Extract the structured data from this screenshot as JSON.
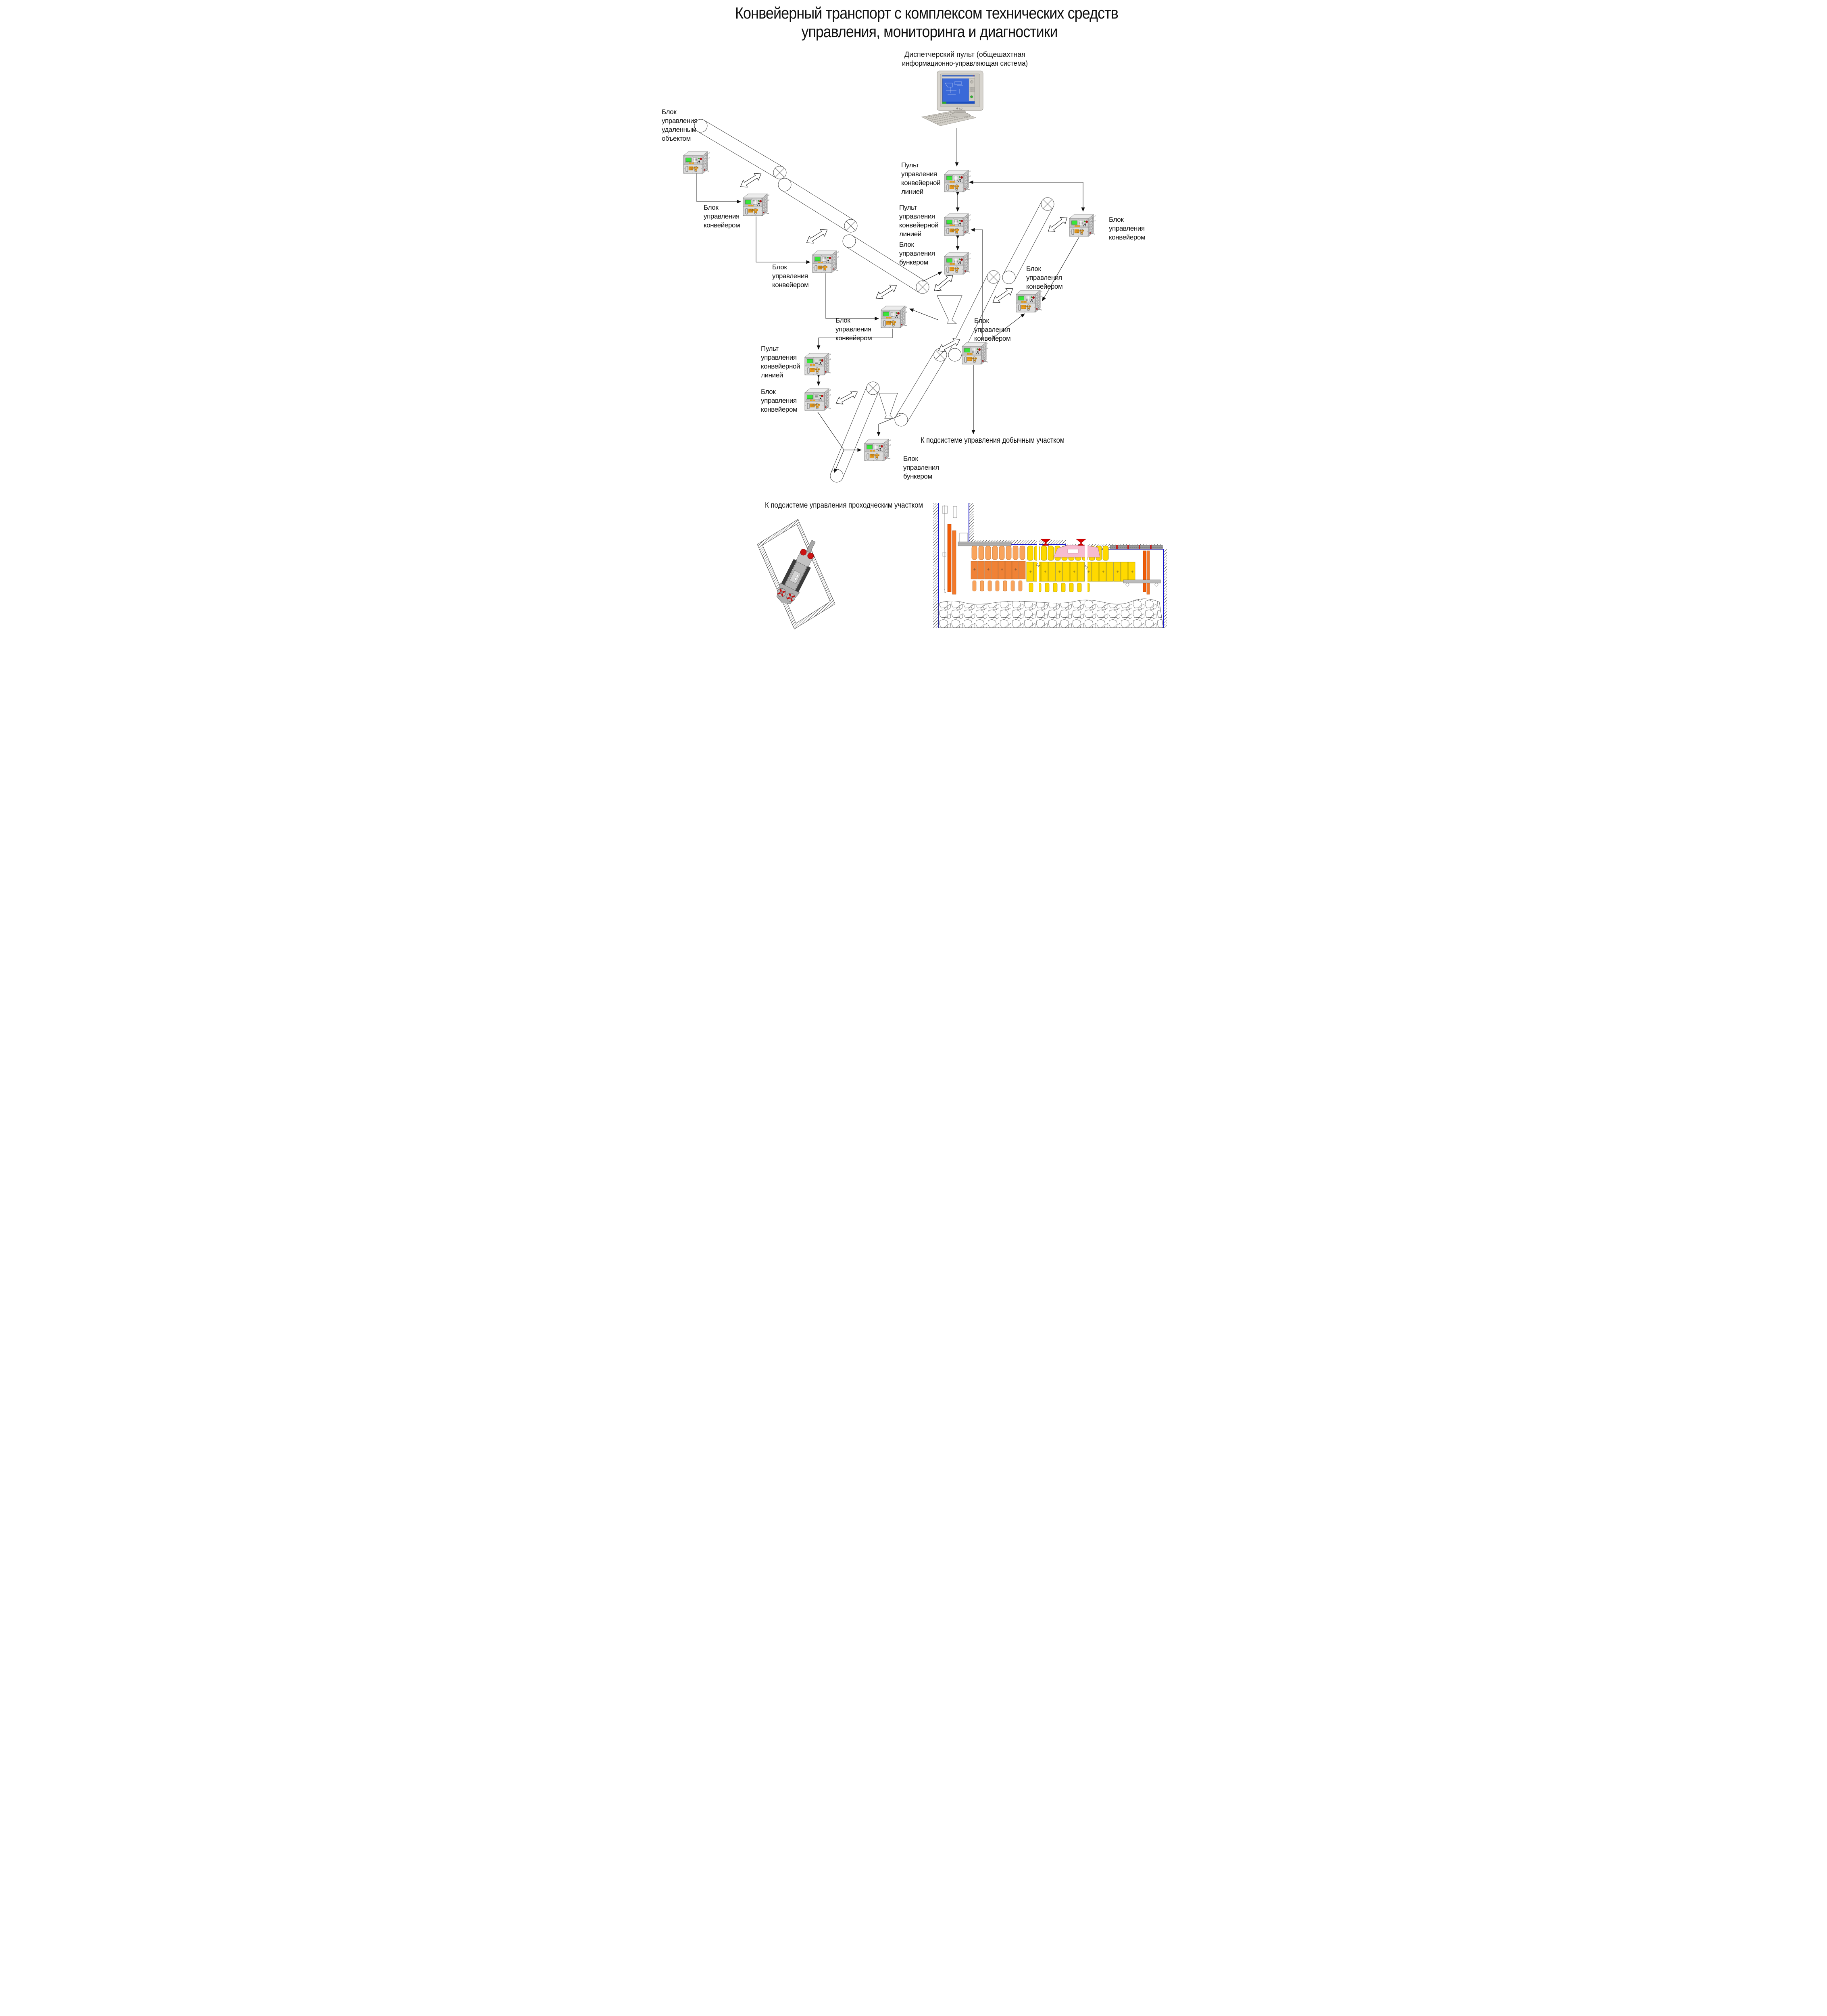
{
  "title": {
    "line1": "Конвейерный транспорт с комплексом технических средств",
    "line2": "управления, мониторинга и диагностики"
  },
  "dispatcher_label": {
    "line1": "Диспетчерский пульт (общешахтная",
    "line2": "информационно-управляющая система)"
  },
  "labels": {
    "remote_object_unit": [
      "Блок",
      "управления",
      "удаленным",
      "объектом"
    ],
    "conveyor_unit": [
      "Блок",
      "управления",
      "конвейером"
    ],
    "line_console": [
      "Пульт",
      "управления",
      "конвейерной",
      "линией"
    ],
    "bunker_unit": [
      "Блок",
      "управления",
      "бункером"
    ]
  },
  "notes": {
    "to_mining_section": "К подсистеме управления добычным участком",
    "to_heading_section": "К подсистеме управления проходческим участком"
  },
  "computer": {
    "brand": "LG"
  },
  "device_faceplate": {
    "warning_lines": [
      "ОТКРЫВАТЬ",
      "ОТКЛЮЧИВ",
      "ОТ СЕТИ"
    ],
    "tag_rv": "РВ",
    "tag_2v": "2В",
    "tag_ia": "Иа"
  },
  "colors": {
    "screen_green": "#39e639",
    "alarm_red": "#d01818",
    "label_orange": "#f5a21c",
    "support_yellow": "#ffd900",
    "support_orange": "#f9a45c",
    "shaft_conveyor_orange": "#f25c05",
    "outline_blue": "#1111cc",
    "machine_pink": "#f6bcd0",
    "pc_screen_blue": "#3a69d8"
  }
}
